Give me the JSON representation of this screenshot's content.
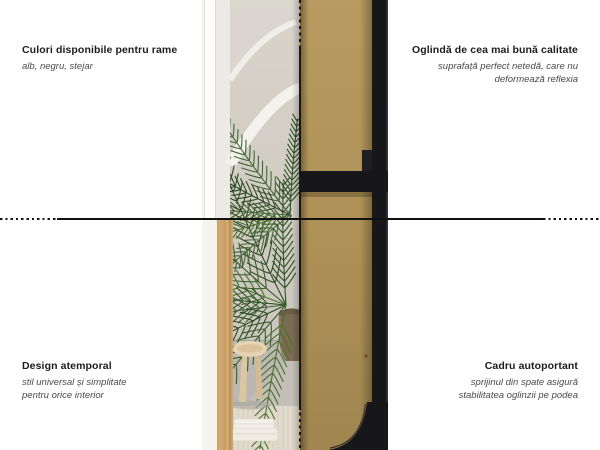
{
  "callouts": {
    "top_left": {
      "title": "Culori disponibile pentru rame",
      "lines": [
        "alb, negru, stejar"
      ]
    },
    "top_right": {
      "title": "Oglindă de cea mai bună calitate",
      "lines": [
        "suprafață perfect netedă, care nu",
        "deformează reflexia"
      ]
    },
    "bottom_left": {
      "title": "Design atemporal",
      "lines": [
        "stil universal și simplitate",
        "pentru orice interior"
      ]
    },
    "bottom_right": {
      "title": "Cadru autoportant",
      "lines": [
        "sprijinul din spate asigură",
        "stabilitatea oglinzii pe podea"
      ]
    }
  },
  "image": {
    "front_view": "mirror front view: white frame (top) and oak frame (bottom) reflecting arched wall, palm plant, wooden stool and rug",
    "back_view": "mirror back view: kraft MDF panel with black self-supporting metal frame"
  },
  "colors": {
    "frame_black": "#17171a",
    "mdf_board": "#b0925a",
    "oak_frame": "#cfa873",
    "divider_line": "#141414",
    "wall_greige": "#d2cec6"
  }
}
